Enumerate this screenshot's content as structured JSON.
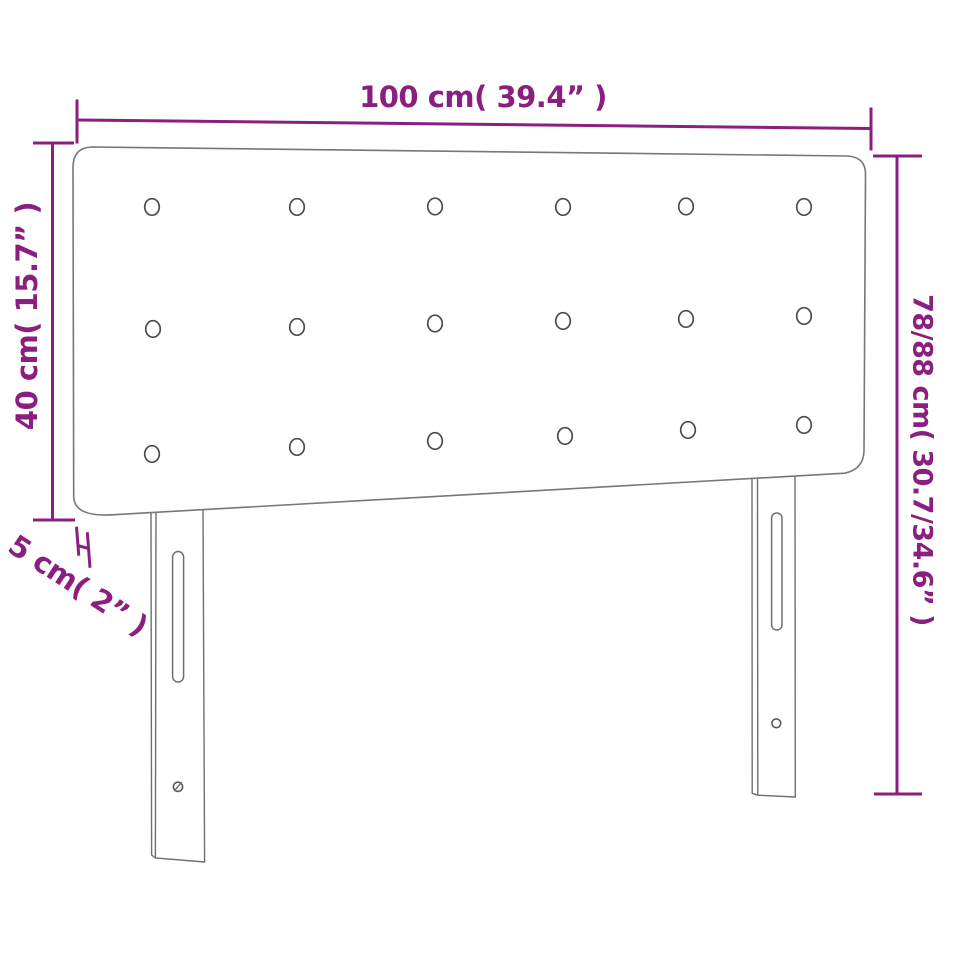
{
  "diagram": {
    "title": "headboard-dimension-diagram",
    "object": "upholstered headboard with two adjustable legs",
    "buttons_rows": 3,
    "buttons_cols": 6,
    "legs": 2
  },
  "dimensions": {
    "width": {
      "label": "100 cm( 39.4” )"
    },
    "panel_height": {
      "label": "40 cm( 15.7” )"
    },
    "leg_gap": {
      "label": "5 cm( 2” )"
    },
    "total_height": {
      "label": "78/88 cm( 30.7/34.6” )"
    }
  },
  "colors": {
    "dimension_accent": "#8B1F80",
    "product_outline": "#777777",
    "button_outline": "#4D4D4D",
    "background": "#FFFFFF"
  }
}
